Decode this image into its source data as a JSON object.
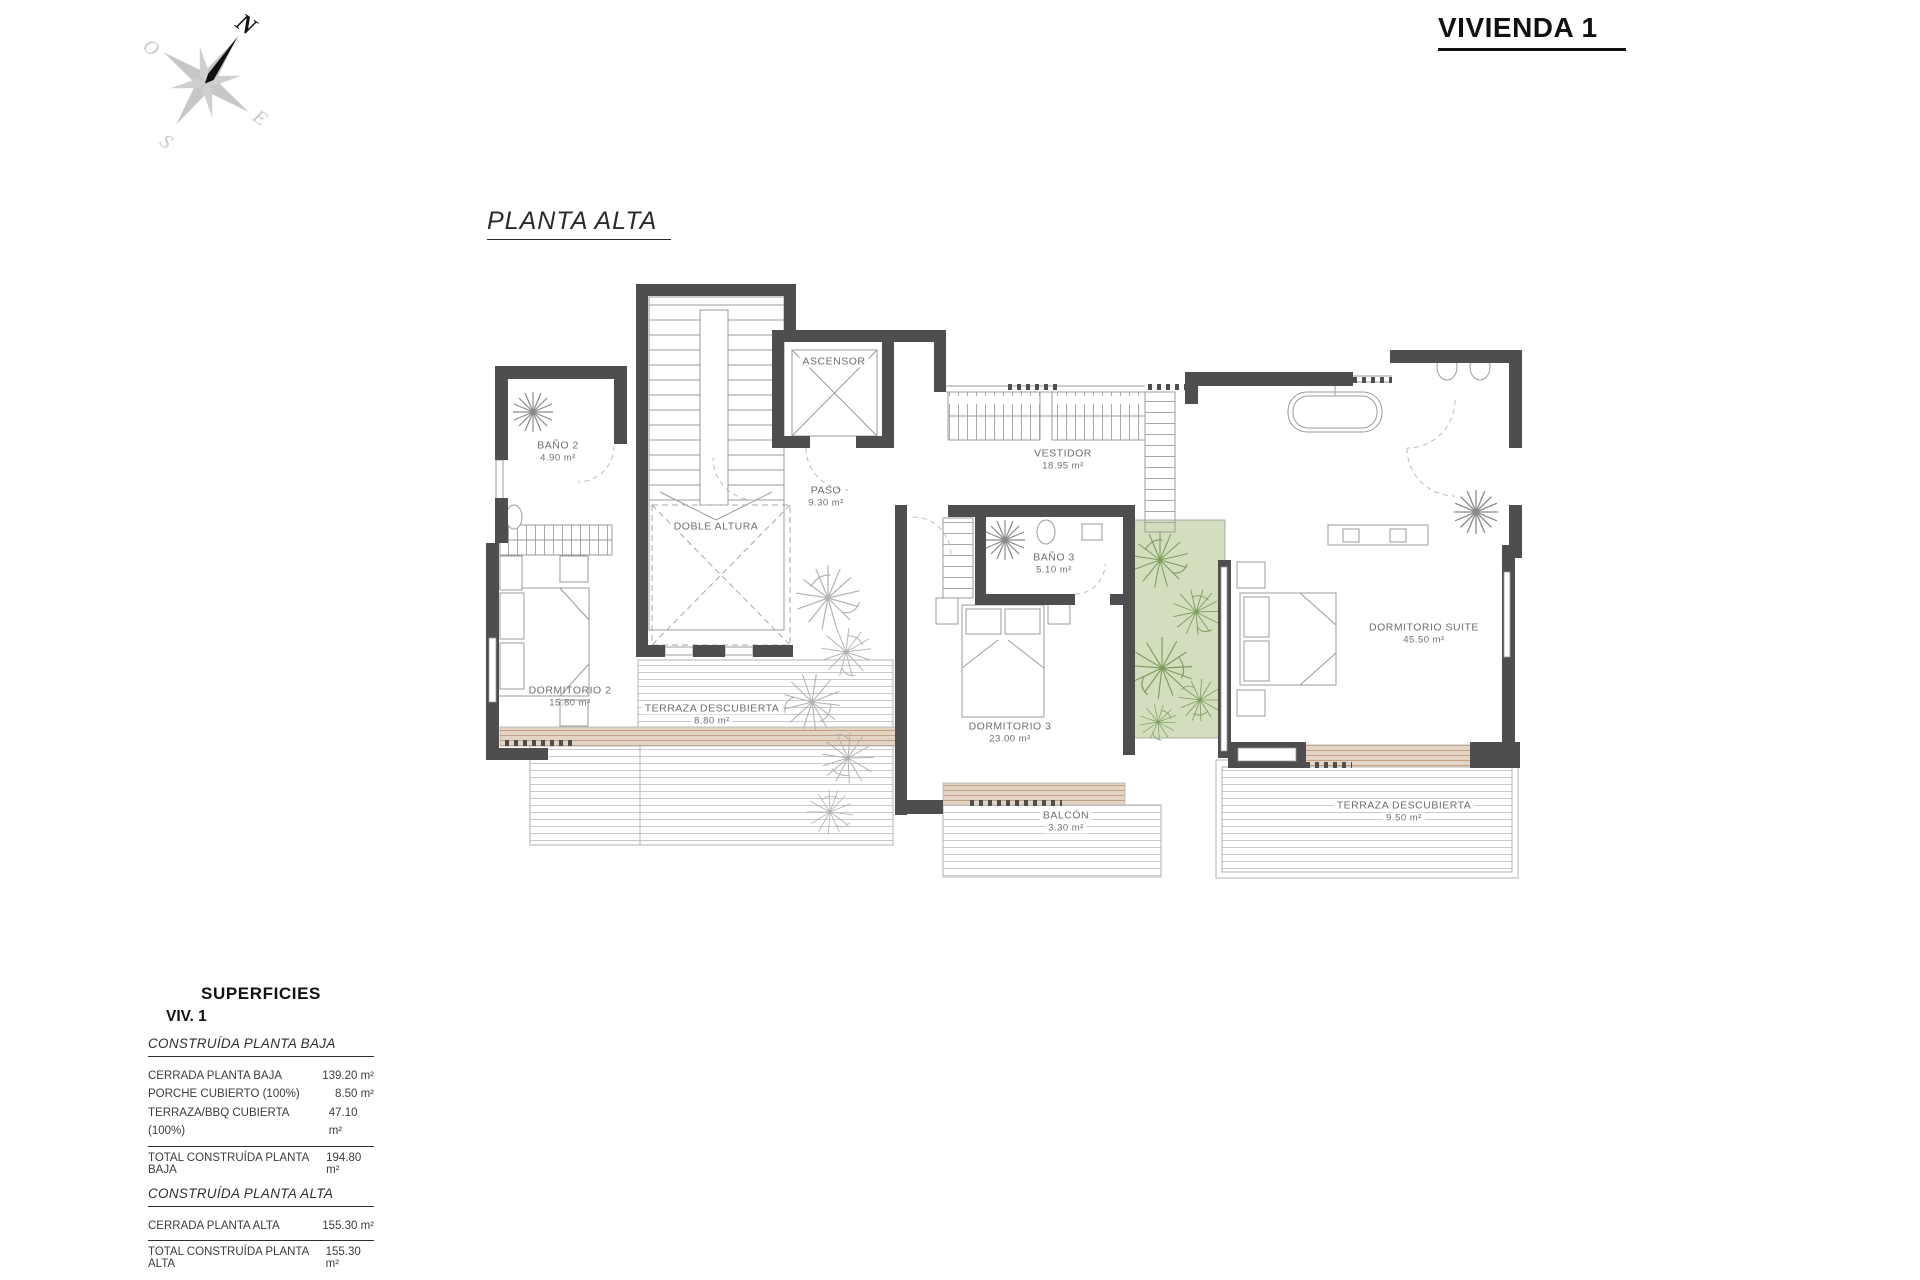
{
  "header": {
    "project_title": "VIVIENDA 1"
  },
  "plan": {
    "title": "PLANTA ALTA",
    "rooms": [
      {
        "name": "BAÑO 2",
        "area": "4.90 m²"
      },
      {
        "name": "DOBLE ALTURA",
        "area": ""
      },
      {
        "name": "ASCENSOR",
        "area": ""
      },
      {
        "name": "PASO",
        "area": "9.30 m²"
      },
      {
        "name": "VESTIDOR",
        "area": "18.95 m²"
      },
      {
        "name": "BAÑO 3",
        "area": "5.10 m²"
      },
      {
        "name": "DORMITORIO 2",
        "area": "15.80 m²"
      },
      {
        "name": "TERRAZA DESCUBIERTA",
        "area": "8.80 m²"
      },
      {
        "name": "DORMITORIO 3",
        "area": "23.00 m²"
      },
      {
        "name": "BALCÓN",
        "area": "3.30 m²"
      },
      {
        "name": "DORMITORIO SUITE",
        "area": "45.50 m²"
      },
      {
        "name": "TERRAZA DESCUBIERTA",
        "area": "9.50 m²"
      }
    ]
  },
  "compass": {
    "north": "N",
    "south": "S",
    "east": "E",
    "west": "O"
  },
  "surfaces": {
    "title": "SUPERFICIES",
    "subtitle": "VIV. 1",
    "sections": [
      {
        "heading": "CONSTRUÍDA PLANTA BAJA",
        "rows": [
          {
            "label": "CERRADA PLANTA BAJA",
            "value": "139.20 m²"
          },
          {
            "label": "PORCHE CUBIERTO (100%)",
            "value": "8.50 m²"
          },
          {
            "label": "TERRAZA/BBQ CUBIERTA (100%)",
            "value": "47.10 m²"
          }
        ],
        "total": {
          "label": "TOTAL CONSTRUÍDA PLANTA BAJA",
          "value": "194.80 m²"
        }
      },
      {
        "heading": "CONSTRUÍDA PLANTA ALTA",
        "rows": [
          {
            "label": "CERRADA PLANTA ALTA",
            "value": "155.30 m²"
          }
        ],
        "total": {
          "label": "TOTAL CONSTRUÍDA PLANTA ALTA",
          "value": "155.30 m²"
        }
      }
    ],
    "grand_total": {
      "label": "TOTAL CONSTRUÍDA VIVIENDA 1",
      "value": "350.10 m²"
    }
  },
  "colors": {
    "wall": "#4e4e4e",
    "deck_tan": "#e3d4c3",
    "patio_green": "#d3debf",
    "plant_green": "#7d9c5c"
  }
}
